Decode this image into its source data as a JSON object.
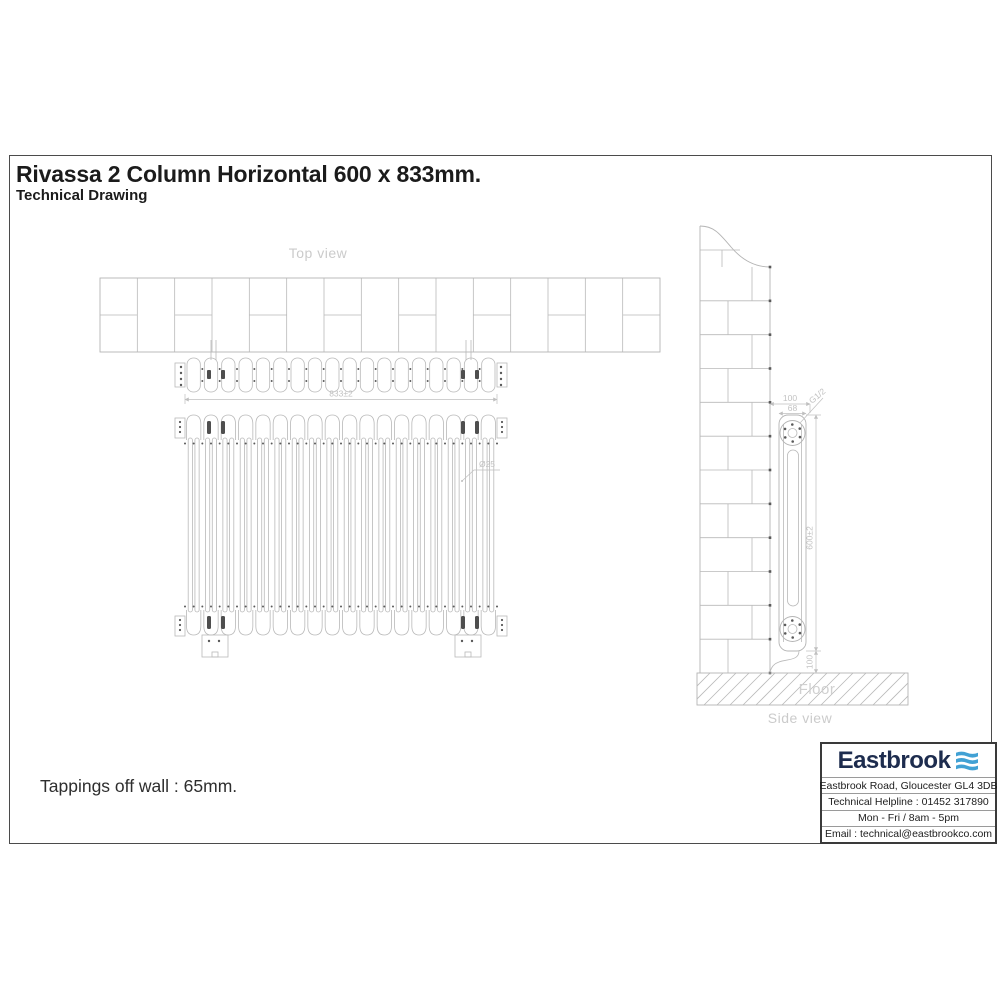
{
  "header": {
    "title": "Rivassa 2 Column Horizontal 600 x 833mm.",
    "subtitle": "Technical Drawing"
  },
  "drawing": {
    "top_view_label": "Top view",
    "side_view_label": "Side view",
    "floor_label": "Floor",
    "sections": 18,
    "columns_per_section": 2,
    "dimensions": {
      "overall_width": "833±2",
      "column_diameter": "Ø25",
      "wall_to_front": "100",
      "depth": "68",
      "tapping_thread": "G1/2",
      "height": "600±2",
      "floor_clearance": "100"
    }
  },
  "footer": {
    "note": "Tappings off wall : 65mm."
  },
  "info_box": {
    "brand": "Eastbrook",
    "address": "Eastbrook Road, Gloucester GL4 3DB",
    "helpline": "Technical Helpline : 01452 317890",
    "hours": "Mon - Fri / 8am - 5pm",
    "email": "Email : technical@eastbrookco.com"
  },
  "colors": {
    "line": "#b9b9b9",
    "dim_text": "#c2c2c2",
    "label_text": "#cbcbcb",
    "title_text": "#1b1b1b",
    "brand_navy": "#1d2c4e",
    "brand_blue": "#41a1d4"
  }
}
